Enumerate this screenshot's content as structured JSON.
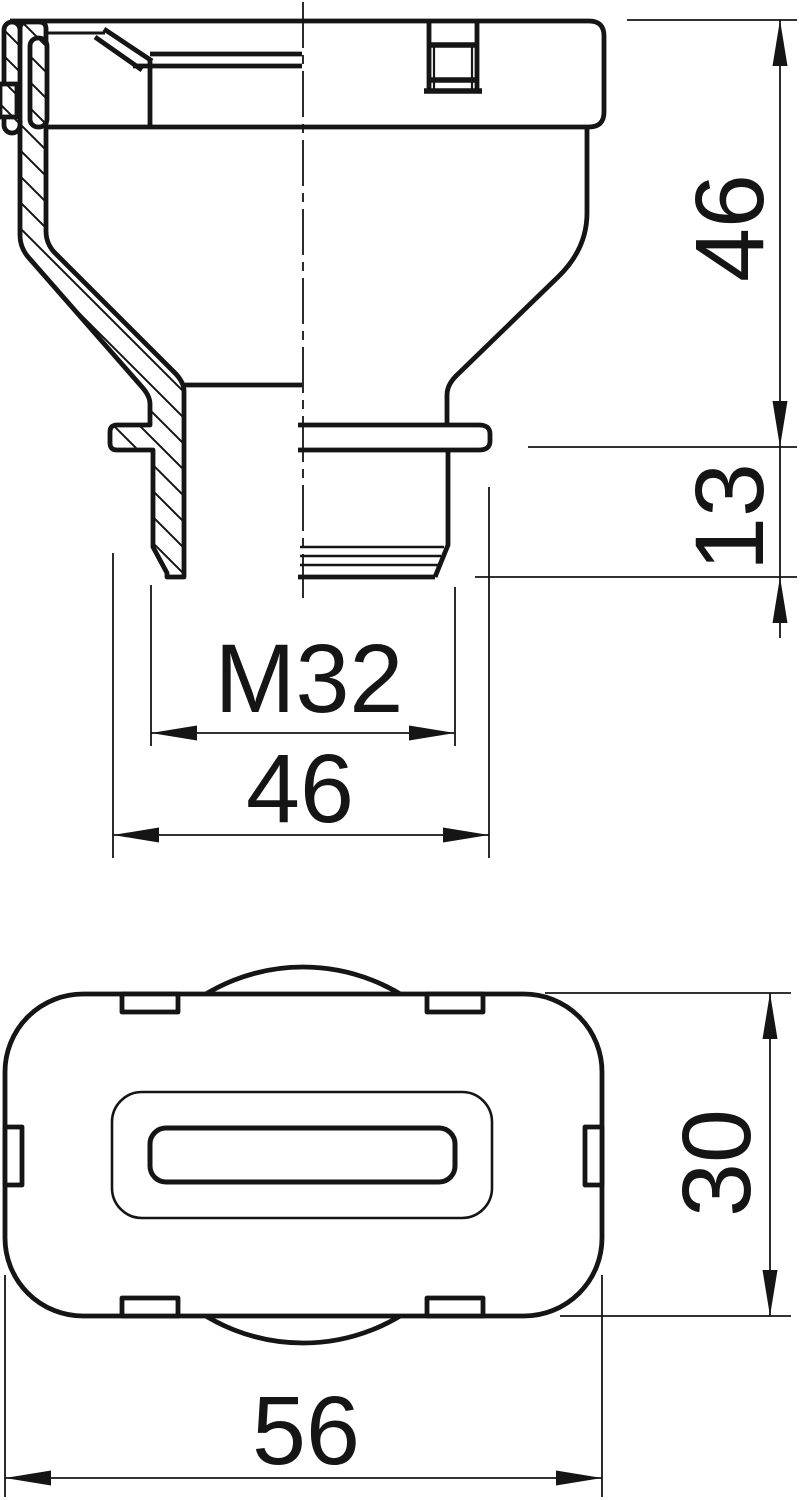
{
  "colors": {
    "line": "#151515",
    "background": "#ffffff"
  },
  "front_view": {
    "dim_overall_height": "46",
    "dim_thread_length": "13",
    "dim_thread_size": "M32",
    "dim_flange_diameter": "46"
  },
  "plan_view": {
    "dim_depth": "30",
    "dim_width": "56"
  }
}
